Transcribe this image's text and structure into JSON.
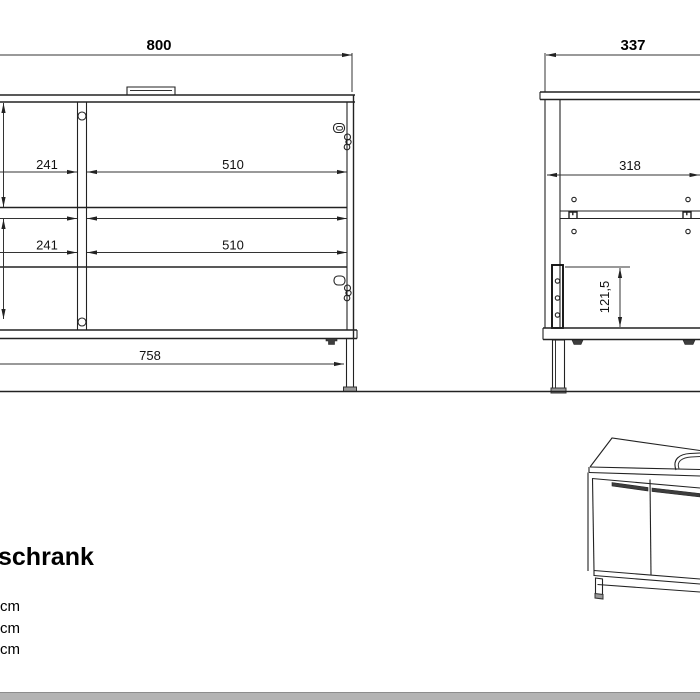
{
  "drawing": {
    "front_view": {
      "width": "800",
      "upper_left_width": "241",
      "upper_right_width": "510",
      "lower_left_width": "241",
      "lower_right_width": "510",
      "plinth_width": "758"
    },
    "side_view": {
      "depth": "337",
      "inner_depth": "318",
      "strip_height": "121,5"
    }
  },
  "footer": {
    "title_fragment": "schrank",
    "spec_lines": [
      "cm",
      "cm",
      "cm"
    ]
  },
  "colors": {
    "line": "#222222",
    "handle": "#3d3d3d",
    "footer_bar": "#b4b4b4"
  }
}
